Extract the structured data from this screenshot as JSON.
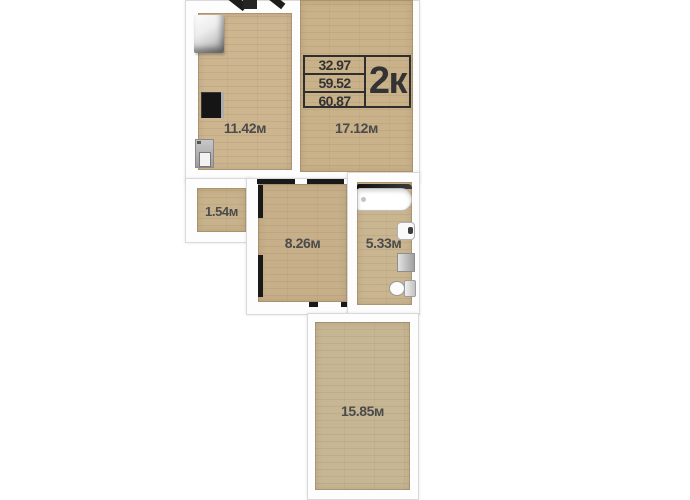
{
  "info_box": {
    "values": [
      "32.97",
      "59.52",
      "60.87"
    ],
    "type": "2к"
  },
  "rooms": {
    "kitchen": {
      "label": "11.42м"
    },
    "living": {
      "label": "17.12м"
    },
    "storage": {
      "label": "1.54м"
    },
    "hall": {
      "label": "8.26м"
    },
    "bathroom": {
      "label": "5.33м"
    },
    "bedroom": {
      "label": "15.85м"
    }
  },
  "fixtures": [
    "fridge",
    "stove",
    "kitchen-sink",
    "door-leaf",
    "bathtub",
    "washbasin",
    "washing-machine",
    "toilet"
  ],
  "colors": {
    "floor": "#cbb48e",
    "wall": "#fdfdfd",
    "wall_edge": "#d9d9d9",
    "label_text": "#4b4b4b",
    "frame": "#2e2e2e"
  }
}
